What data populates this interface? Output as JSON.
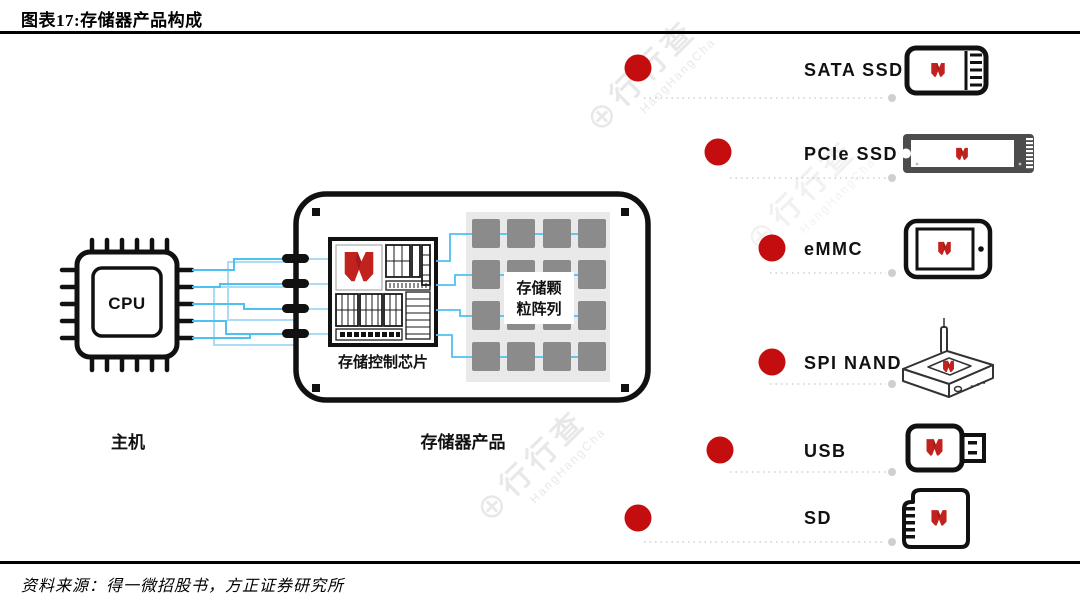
{
  "header": {
    "title": "图表17:存储器产品构成"
  },
  "footer": {
    "source": "资料来源：得一微招股书，方正证券研究所"
  },
  "host": {
    "chip": "CPU",
    "label": "主机"
  },
  "board": {
    "label": "存储器产品",
    "controller_label": "存储控制芯片",
    "array_label_line1": "存储颗",
    "array_label_line2": "粒阵列"
  },
  "products": [
    {
      "name": "SATA SSD"
    },
    {
      "name": "PCIe SSD"
    },
    {
      "name": "eMMC"
    },
    {
      "name": "SPI NAND"
    },
    {
      "name": "USB"
    },
    {
      "name": "SD"
    }
  ],
  "watermark": {
    "symbol": "⊕",
    "text": "行行查",
    "subtext": "HangHangCha"
  },
  "colors": {
    "accent_red": "#c40d0e",
    "logo_red": "#c2221e",
    "logo_red_dark": "#8f1616",
    "line_blue": "#4fc0ef",
    "line_blue_light": "#a9ddf6",
    "array_gray": "#8b8b8b",
    "array_bg": "#e9e9e9",
    "dotted_gray": "#cfcfcf"
  }
}
